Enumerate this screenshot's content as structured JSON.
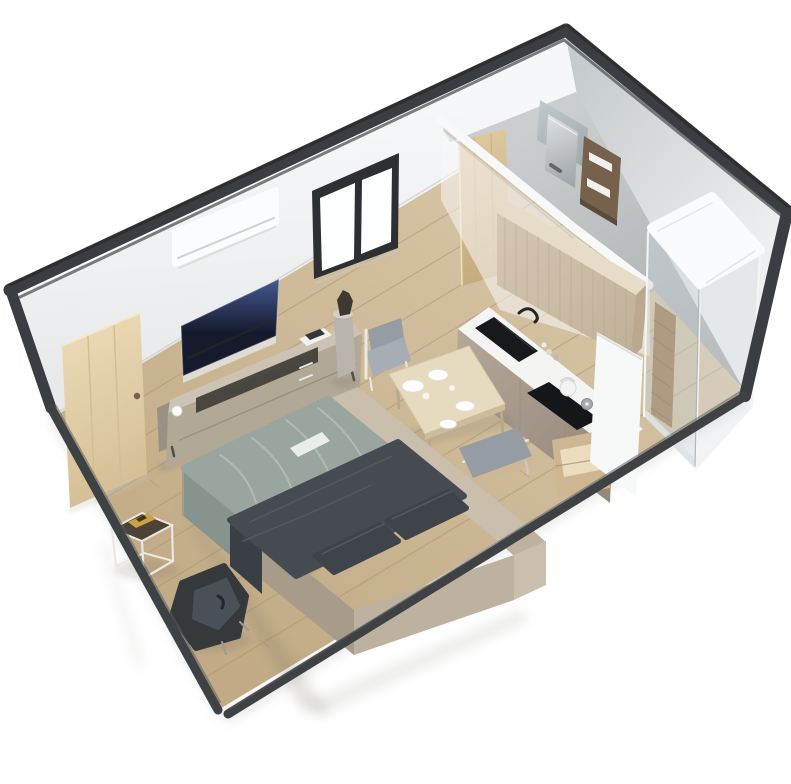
{
  "scene": {
    "title": "3D isometric rendering of a container tiny-home studio floor plan",
    "canvas": {
      "width": 791,
      "height": 784
    },
    "rooms": [
      {
        "id": "living-sleeping-area"
      },
      {
        "id": "kitchen-dining-area"
      },
      {
        "id": "bathroom"
      }
    ],
    "items": [
      {
        "id": "container-frame"
      },
      {
        "id": "wood-floor"
      },
      {
        "id": "bathroom-floor"
      },
      {
        "id": "window"
      },
      {
        "id": "ac-unit"
      },
      {
        "id": "wall-tv"
      },
      {
        "id": "media-console"
      },
      {
        "id": "interior-door"
      },
      {
        "id": "double-bed"
      },
      {
        "id": "armchair"
      },
      {
        "id": "side-table"
      },
      {
        "id": "pedestal-sculpture"
      },
      {
        "id": "dining-table"
      },
      {
        "id": "dining-chair"
      },
      {
        "id": "dining-bench"
      },
      {
        "id": "kitchen-counter-sink"
      },
      {
        "id": "cooktop"
      },
      {
        "id": "tall-cabinet"
      },
      {
        "id": "base-cabinet"
      },
      {
        "id": "partition-wall"
      },
      {
        "id": "bathroom-door"
      },
      {
        "id": "vanity-shelf"
      },
      {
        "id": "water-heater"
      },
      {
        "id": "shower-enclosure"
      }
    ]
  },
  "colors": {
    "bg": "#ffffff",
    "frame-dark": "#3a3d41",
    "frame-rim": "#3f4245",
    "frame-highlight": "#5a5e62",
    "wall-left-top": "#f6f7f8",
    "wall-left-bottom": "#e6e7e8",
    "wall-right-near": "#c6cbcd",
    "wall-right-far": "#edeff0",
    "floor-light": "#dac9aa",
    "floor-dark": "#c1aa85",
    "plank": "#a98f68",
    "bath-floor-light": "#cbcecf",
    "bath-floor-dark": "#a8acae",
    "window-frame": "#2d3033",
    "glazing": "#fdfefe",
    "ac-white": "#fbfcfd",
    "tv-dark": "#151a2d",
    "tv-glow": "#44588f",
    "tv-shelf": "#dfdcd6",
    "console-top": "#ccc3b4",
    "console-front": "#b2a896",
    "console-end": "#9a9183",
    "console-slot": "#403d37",
    "tray-white": "#f2f1ee",
    "tray-item": "#33373c",
    "door-wood-light": "#ead9b4",
    "door-wood-dark": "#d4bd93",
    "entry-door-light": "#dcc69c",
    "entry-door-dark": "#c4aa7c",
    "duvet": "#99a69f",
    "duvet-drape": "#87948e",
    "duvet-fold": "#b6c0ba",
    "bed-white": "#eef0ee",
    "blanket": "#464b51",
    "blanket-drape": "#3a3f45",
    "pillow": "#3f444b",
    "platform": "#bdb2a0",
    "platform-lit": "#cabfad",
    "platform-shade": "#a79c8a",
    "sidetable-top": "#4e4236",
    "gold": "#c8a245",
    "metal-white": "#eae8e3",
    "armchair": "#35393c",
    "armchair-inner": "#4a5057",
    "table-top": "#e6dabf",
    "table-edge": "#cbbc9c",
    "table-leg": "#b8a98a",
    "chair-cushion": "#959ca3",
    "chair-seat": "#a6adb4",
    "bench-base": "#cdb896",
    "counter-top": "#f4f4f3",
    "counter-front-light": "#b3a597",
    "counter-front-dark": "#95877a",
    "sink-black": "#17191b",
    "cooktop-black": "#141619",
    "kettle": "#f2f3f2",
    "pot": "#a7acb0",
    "cabinet-top": "#e6dcc8",
    "cabinet-front-light": "#d4c7b2",
    "cabinet-front-dark": "#c0b098",
    "cabinet-grain": "#b5a489",
    "cabinet-side": "#baa98f",
    "basecab": "#cdb691",
    "basecab-inner": "#e9ddbe",
    "partition": "#f7f8f8",
    "vanity": "#76614c",
    "vanity-dark": "#5d4b39",
    "towel": "#f2f0ec",
    "appliance-light": "#dfe2e4",
    "appliance-dark": "#9da2a6",
    "mirror-light": "#c2c9cd",
    "mirror-dark": "#9fa6aa",
    "shower-top": "#fafbfc",
    "glass": "#c9d2d6",
    "glass-2": "#d8dee1",
    "glass-edge": "#f4f6f6",
    "shower-column": "#9d7446",
    "column-slat": "#7c5a34",
    "pedestal": "#b9b4ab",
    "sculpture": "#3e3a33",
    "plate": "#fdfdfd",
    "shadow": "#6b655a",
    "drawer-line": "#978d7e",
    "soft-line": "#c7c6c2",
    "dark-line": "#23262a"
  }
}
